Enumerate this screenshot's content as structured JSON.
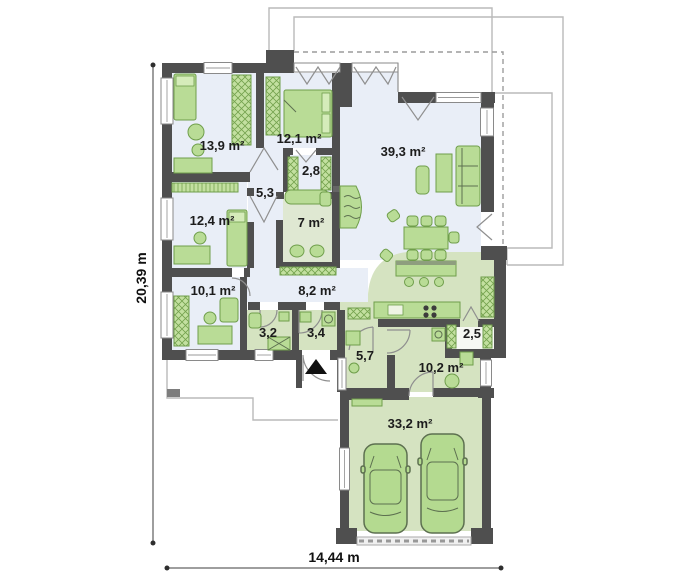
{
  "plan_title": "single-storey house floor plan with double garage",
  "rooms": {
    "bedroom1": "13,9 m²",
    "bedroom2": "12,1 m²",
    "closet": "2,8",
    "corridor": "5,3",
    "bathroom": "7 m²",
    "living": "39,3 m²",
    "bedroom3": "12,4 m²",
    "bedroom4": "10,1 m²",
    "hall": "8,2 m²",
    "wc": "3,2",
    "vestibule": "3,4",
    "entry": "5,7",
    "utility": "10,2 m²",
    "pantry": "2,5",
    "garage": "33,2 m²"
  },
  "dimensions": {
    "height": "20,39 m",
    "width": "14,44 m"
  },
  "palette": {
    "wall": "#4f4f4f",
    "floor_main": "#e9eef7",
    "floor_service": "#d5e3c1",
    "floor_bath": "#dfe8d2",
    "furniture": "#b9dc96",
    "furniture_stroke": "#6f9e4b"
  }
}
